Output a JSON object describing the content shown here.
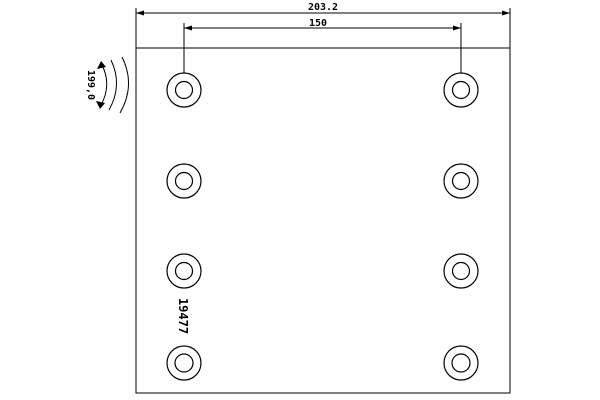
{
  "drawing": {
    "type": "brake-lining-technical-drawing",
    "part_number": "19477",
    "dimensions": {
      "overall_width": "203.2",
      "hole_spacing": "150",
      "arc_radius": "199,0"
    },
    "holes": {
      "columns": 2,
      "rows": 4
    }
  },
  "colors": {
    "line": "#000000",
    "background": "#ffffff"
  }
}
